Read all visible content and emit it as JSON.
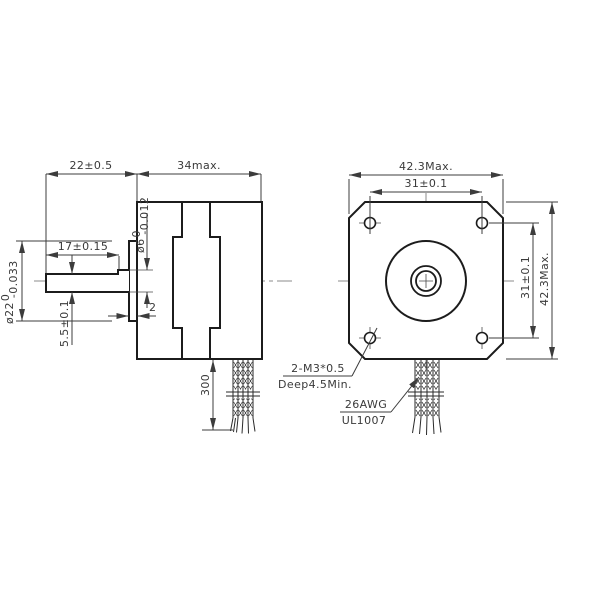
{
  "drawing": {
    "type": "stepper-motor-dimension-drawing",
    "background_color": "#ffffff",
    "outline_color": "#1c1c1c",
    "dimension_color": "#3c3c3c",
    "centerline_color": "#8b8b8b"
  },
  "side_view": {
    "shaft_length": "22±0.5",
    "body_length": "34max.",
    "flat_length": "17±0.15",
    "shaft_diameter": {
      "main": "ø6",
      "sup": "0",
      "sub": "-0.012"
    },
    "pilot_diameter": {
      "main": "ø22",
      "sup": "0",
      "sub": "-0.033"
    },
    "flat_height": "5.5±0.1",
    "pilot_depth": "2",
    "lead_length": "300"
  },
  "front_view": {
    "width_max": "42.3Max.",
    "hole_pitch_horizontal": "31±0.1",
    "hole_pitch_vertical": "31±0.1",
    "height_max": "42.3Max.",
    "tapped_hole_note": {
      "line1": "2-M3*0.5",
      "line2": "Deep4.5Min."
    },
    "lead_wire_note": {
      "line1": "26AWG",
      "line2": "UL1007"
    }
  }
}
